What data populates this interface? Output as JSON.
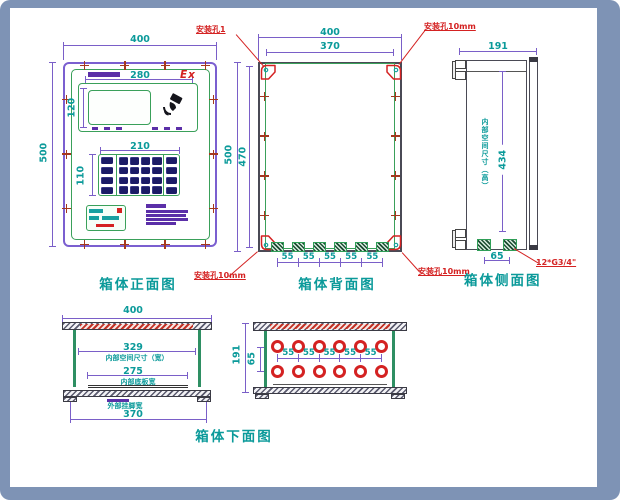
{
  "colors": {
    "frame_blue": "#7e93b5",
    "dimension_teal": "#0b9a9a",
    "dimension_purple": "#7a5fc8",
    "outline_green": "#3aa05a",
    "annotation_red": "#d42222",
    "keypad_navy": "#1b1b66"
  },
  "front_view": {
    "title": "箱体正面图",
    "dim_w": "400",
    "dim_h": "500",
    "display_dim_w": "280",
    "display_dim_h": "120",
    "ex_mark": "Ex",
    "keypad_dim_w": "210",
    "keypad_dim_h": "110"
  },
  "back_view": {
    "title": "箱体背面图",
    "dim_w_outer": "400",
    "dim_w_inner": "370",
    "dim_h_outer": "500",
    "dim_h_inner": "470",
    "hole_spacings": [
      "55",
      "55",
      "55",
      "55",
      "55"
    ],
    "label_hole_tl": "安装孔1",
    "label_hole_tr": "安装孔10mm",
    "label_hole_bl": "安装孔10mm",
    "label_hole_br": "安装孔10mm"
  },
  "side_view": {
    "title": "箱体侧面图",
    "dim_w": "191",
    "dim_inner_h": "434",
    "inner_h_label": "内部空间尺寸（高）",
    "dim_gland_spacing": "65",
    "gland_spec": "12*G3/4\""
  },
  "section_view": {
    "dim_w": "400",
    "dim_inner_w": "329",
    "inner_w_label": "内部空间尺寸（宽）",
    "dim_plate_w": "275",
    "plate_label": "内部底板宽",
    "ear_label": "外部挂脚宽",
    "dim_ear_w": "370"
  },
  "bottom_view": {
    "title": "箱体下面图",
    "dim_h": "191",
    "dim_row_gap": "65",
    "hole_spacings": [
      "55",
      "55",
      "55",
      "55",
      "55"
    ]
  }
}
